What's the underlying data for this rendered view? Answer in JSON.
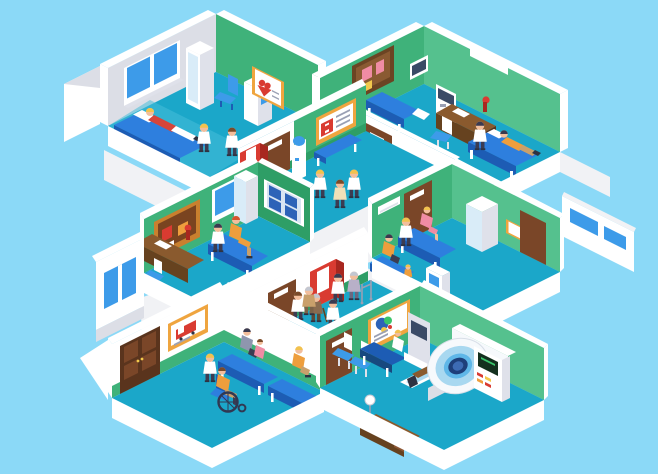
{
  "scene": {
    "title": "Isometric hospital interior cutaway illustration with doctors and patients",
    "background": "#8BD9F7"
  },
  "palette": {
    "bg": "#8BD9F7",
    "white": "#FFFFFF",
    "slab": "#F1F2F5",
    "slab2": "#DCDEE6",
    "slab3": "#C7CAD4",
    "green": "#3FB27A",
    "green2": "#2E9E66",
    "green3": "#55C18E",
    "floor": "#1BA7C9",
    "floor2": "#46BDD9",
    "door": "#7A4628",
    "doorD": "#5A341D",
    "doorM": "#8C5633",
    "wood": "#8A5A2E",
    "woodD": "#66421F",
    "blue": "#2E7FDE",
    "blueD": "#1D5CB4",
    "win": "#3D9BE9",
    "paleblue": "#D9ECF8",
    "poster": "#EFA53F",
    "posterD": "#C9802E",
    "cork": "#7A4420",
    "red": "#D93B31",
    "redD": "#A8271F",
    "panel": "#3A4A66",
    "xfilm": "#2D63B8",
    "xbg": "#D8E4F2",
    "coat": "#FFFFFF",
    "coat2": "#DFE1EA",
    "skin": "#F2BE9C",
    "blond": "#F2C24E",
    "hairD": "#3A3A50",
    "hairG": "#C3C7D1",
    "hairR": "#D4552E",
    "hairB": "#7A4B2A",
    "orange": "#EE9E3D",
    "pink": "#F08CA4",
    "pants": "#3C3C52",
    "tan": "#C9A06B",
    "lav": "#B8B0C8",
    "browncoat": "#8A6B4F",
    "mri1": "#F6F9FC",
    "mri2": "#A8D8F0",
    "mri3": "#5FB7E8",
    "bore": "#1E3F7A",
    "boreIn": "#3D6BB4",
    "cscreen": "#14301E",
    "cgreen": "#39C46B",
    "yellow": "#F2C94C",
    "gray": "#9AA0B4",
    "dark": "#2E3242"
  },
  "rooms": [
    {
      "id": "ward",
      "name": "Patient ward (top-left)",
      "features": [
        "double window",
        "tall wardrobe cabinet",
        "blue chair",
        "supply cabinet",
        "heart health poster",
        "hospital bed"
      ],
      "people": [
        "patient in red shirt lying on bed",
        "blond doctor with stethoscope",
        "doctor in white coat"
      ]
    },
    {
      "id": "office",
      "name": "Doctor office / exam room (top-right)",
      "features": [
        "cork notice board with pink notes",
        "wall monitor",
        "medical device station",
        "white shelf",
        "blue exam table",
        "wooden desk with red lamp",
        "office chair",
        "hospital bed"
      ],
      "people": [
        "doctor in white coat",
        "patient in orange lying on bed"
      ]
    },
    {
      "id": "corridor-upper",
      "name": "Upper corridor",
      "features": [
        "red first-aid wall poster",
        "blue bench",
        "water cooler",
        "red vending machine",
        "two brown doors"
      ],
      "people": [
        "three doctors talking"
      ]
    },
    {
      "id": "exam",
      "name": "Consultation room (middle-left)",
      "features": [
        "notice board with red notes",
        "window",
        "wooden desk with red lamp",
        "chair",
        "glass-door wardrobe",
        "blue exam bench",
        "x-ray viewer panel",
        "exterior window"
      ],
      "people": [
        "doctor examining",
        "red-haired patient in orange sitting"
      ]
    },
    {
      "id": "pediatric",
      "name": "Pediatric exam room (middle-right)",
      "features": [
        "air vent",
        "glass cabinet",
        "framed picture",
        "brown door",
        "blue exam bench",
        "waiting bench",
        "info kiosk",
        "exterior wall with windows"
      ],
      "people": [
        "blond doctor",
        "child in pink on bench",
        "mother with boy waiting"
      ]
    },
    {
      "id": "corridor-lower",
      "name": "Lower corridor",
      "features": [
        "brown door",
        "red vending machine"
      ],
      "people": [
        "doctor helping elderly patient with walker",
        "elderly man with cane",
        "nurse",
        "doctor with elderly patient walking"
      ]
    },
    {
      "id": "waiting",
      "name": "Waiting room (bottom-left)",
      "features": [
        "large brown entrance double door",
        "ambulance poster",
        "two blue benches"
      ],
      "people": [
        "woman and child seated",
        "man in orange seated",
        "nurse pushing patient in wheelchair"
      ]
    },
    {
      "id": "mri",
      "name": "MRI room (bottom-right)",
      "features": [
        "brain scan poster",
        "brown door",
        "two chairs",
        "blue table",
        "operator workstation",
        "MRI scanner",
        "control console",
        "writing desk",
        "floor lamp"
      ],
      "people": [
        "patient lying in MRI scanner",
        "operator at workstation"
      ]
    }
  ]
}
